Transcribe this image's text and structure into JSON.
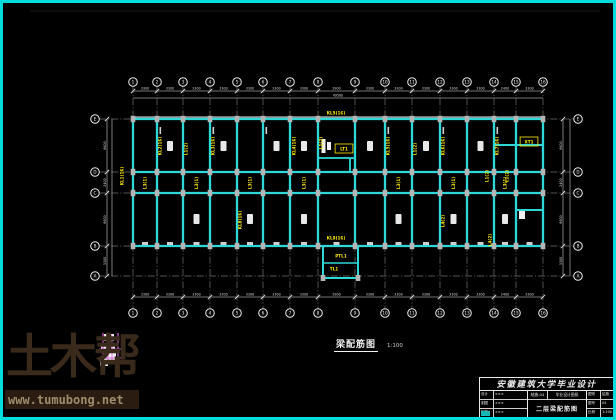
{
  "page": {
    "background": "#000000",
    "border_color": "#00dddd"
  },
  "watermark": {
    "logo": "土木帮",
    "url": "www.tumubong.net",
    "logo_color": "#3a2a1b",
    "bar_color": "#2a1c10"
  },
  "drawing_label": {
    "text": "梁配筋图",
    "scale": "1:100"
  },
  "title_block": {
    "header": "安徽建筑大学毕业设计",
    "left_rows": [
      {
        "label": "设计",
        "value": "×××"
      },
      {
        "label": "制图",
        "value": "×××"
      },
      {
        "label": "审核",
        "value": "×××"
      }
    ],
    "drawing_no": "结施-04",
    "project": "毕业设计图纸",
    "drawing_name": "二层梁配筋图",
    "right_rows": [
      {
        "label": "图别",
        "value": "结施"
      },
      {
        "label": "图号",
        "value": "04"
      },
      {
        "label": "比例",
        "value": "1:100"
      }
    ]
  },
  "plan": {
    "colors": {
      "beam": "#2fd8d8",
      "grid": "#6f6f6f",
      "dimline": "#9a9a9a",
      "dimtext": "#dcdcdc",
      "label": "#ffeb00",
      "column": "#b5b5b5",
      "blob": "#e8e8e8",
      "detail": "#d85fd8"
    },
    "cols": [
      133,
      157,
      183,
      210,
      237,
      263,
      290,
      318,
      355,
      385,
      412,
      440,
      467,
      494,
      516,
      543
    ],
    "col_labels": [
      "1",
      "2",
      "3",
      "4",
      "5",
      "6",
      "7",
      "8",
      "9",
      "10",
      "11",
      "12",
      "13",
      "14",
      "15",
      "16"
    ],
    "rows": [
      119,
      172,
      193,
      246,
      276
    ],
    "row_labels": [
      "E",
      "D",
      "C",
      "B",
      "A"
    ],
    "dim_top": [
      "3300",
      "3300",
      "3300",
      "3300",
      "3300",
      "3300",
      "3300",
      "3900",
      "3300",
      "3300",
      "3300",
      "3300",
      "3300",
      "2400",
      "3300"
    ],
    "dim_side": [
      "6600",
      "2400",
      "6600",
      "3300"
    ],
    "dim_overall": "49500",
    "corridor_label": "L3(1)",
    "corridor_bays": [
      0,
      2,
      4,
      6,
      9,
      11,
      13
    ],
    "labels": [
      {
        "x": 122,
        "y": 176,
        "r": 90,
        "t": "KL1(16)"
      },
      {
        "x": 160,
        "y": 146,
        "r": 90,
        "t": "KL2(16)"
      },
      {
        "x": 186,
        "y": 149,
        "r": 90,
        "t": "L1(2)"
      },
      {
        "x": 213,
        "y": 146,
        "r": 90,
        "t": "KL3(16)"
      },
      {
        "x": 294,
        "y": 146,
        "r": 90,
        "t": "KL4(16)"
      },
      {
        "x": 321,
        "y": 143,
        "r": 90,
        "t": "L1(2)"
      },
      {
        "x": 388,
        "y": 146,
        "r": 90,
        "t": "KL5(16)"
      },
      {
        "x": 415,
        "y": 149,
        "r": 90,
        "t": "L1(2)"
      },
      {
        "x": 443,
        "y": 146,
        "r": 90,
        "t": "KL6(16)"
      },
      {
        "x": 497,
        "y": 146,
        "r": 90,
        "t": "KL7(16)"
      },
      {
        "x": 487,
        "y": 176,
        "r": 90,
        "t": "L1(2)"
      },
      {
        "x": 507,
        "y": 176,
        "r": 90,
        "t": "L1(2)"
      },
      {
        "x": 490,
        "y": 240,
        "r": 90,
        "t": "L4(2)"
      },
      {
        "x": 240,
        "y": 220,
        "r": 90,
        "t": "KL8(16)"
      },
      {
        "x": 443,
        "y": 221,
        "r": 90,
        "t": "L4(2)"
      },
      {
        "x": 336,
        "y": 113,
        "r": 0,
        "t": "KL5(16)"
      },
      {
        "x": 344,
        "y": 149,
        "r": 0,
        "t": "LT1",
        "box": true
      },
      {
        "x": 529,
        "y": 142,
        "r": 0,
        "t": "XT1",
        "box": true
      },
      {
        "x": 336,
        "y": 238,
        "r": 0,
        "t": "KL9(16)"
      },
      {
        "x": 341,
        "y": 256,
        "r": 0,
        "t": "PTL1"
      },
      {
        "x": 334,
        "y": 269,
        "r": 0,
        "t": "TL1"
      }
    ]
  }
}
